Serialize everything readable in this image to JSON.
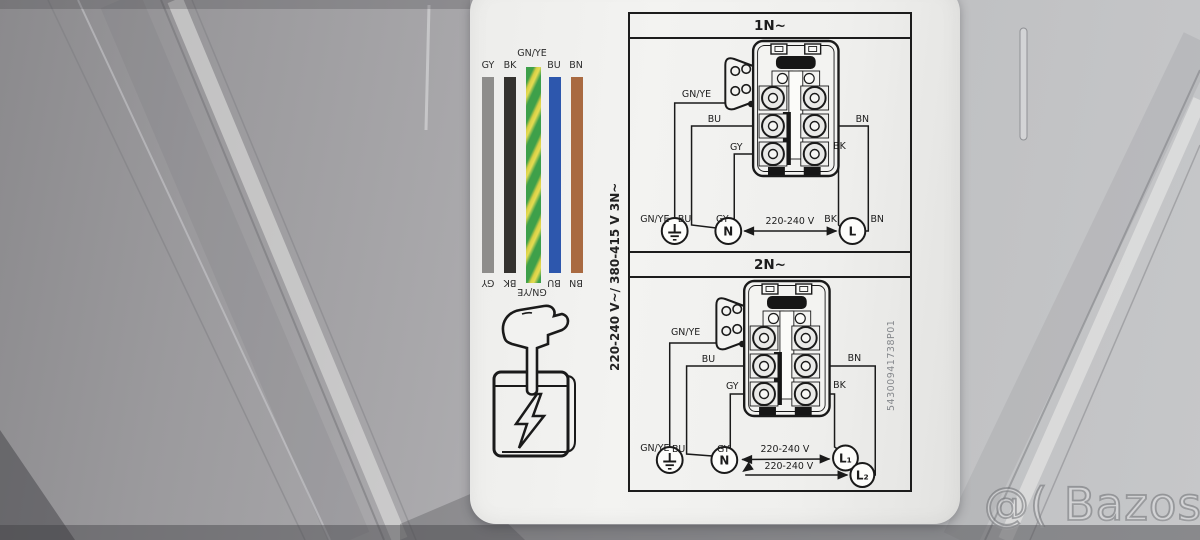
{
  "background": {
    "watermark": "@( Bazos.sk",
    "metal_base_color": "#a9a8ab"
  },
  "label": {
    "paper_color": "#f1f1ef",
    "legend": {
      "bars": [
        {
          "code": "GY",
          "bg": "#8e8d8b"
        },
        {
          "code": "BK",
          "bg": "#34322f"
        },
        {
          "code": "GN/YE",
          "bg": "repeating-linear-gradient(115deg,#3ea04a 0px,#3ea04a 7px,#d9cf45 10px,#e5dc52 13px,#3ea04a 17px)"
        },
        {
          "code": "BU",
          "bg": "#2d57ad"
        },
        {
          "code": "BN",
          "bg": "#a96a41"
        }
      ]
    },
    "manual_icon": "hand-pressing-manual-with-lightning-bolt",
    "side_voltage": "220-240 V~/ 380-415 V 3N~",
    "part_number": "54300941738P01",
    "d1": {
      "title": "1N~",
      "gnye": "GN/YE",
      "bu": "BU",
      "gy": "GY",
      "bk": "BK",
      "bn": "BN",
      "n": "N",
      "l": "L",
      "voltage": "220-240 V"
    },
    "d2": {
      "title": "2N~",
      "gnye": "GN/YE",
      "bu": "BU",
      "gy": "GY",
      "bk": "BK",
      "bn": "BN",
      "n": "N",
      "l1": "L₁",
      "l2": "L₂",
      "voltage1": "220-240 V",
      "voltage2": "220-240 V"
    }
  }
}
